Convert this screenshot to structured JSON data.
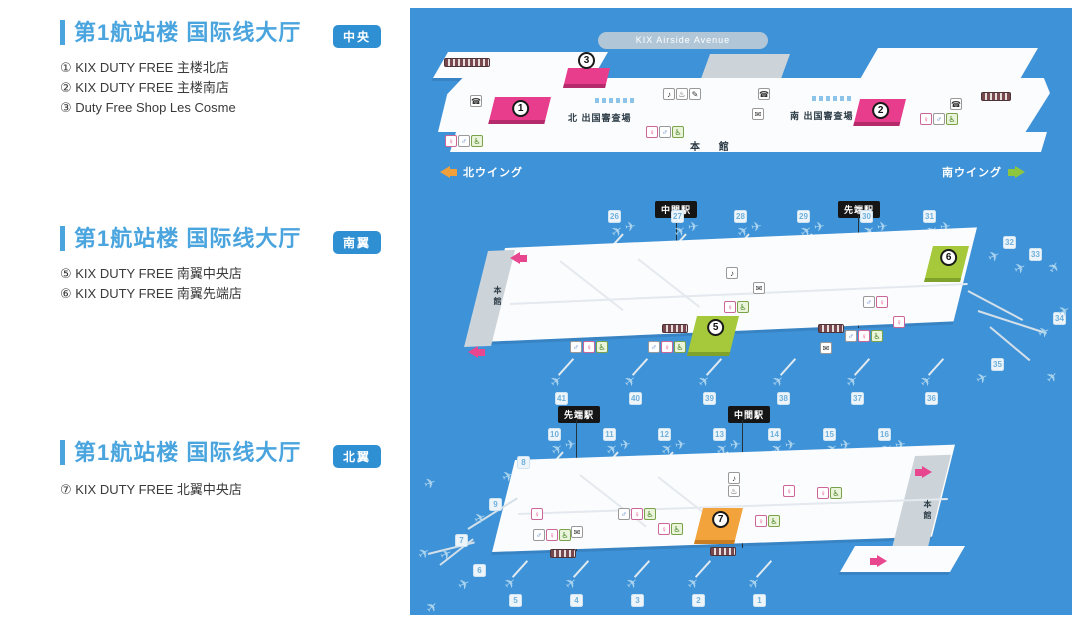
{
  "sections": [
    {
      "title": "第1航站楼 国际线大厅",
      "badge": "中央",
      "items": [
        "① KIX DUTY FREE 主楼北店",
        "② KIX DUTY FREE 主楼南店",
        "③ Duty Free Shop Les Cosme"
      ]
    },
    {
      "title": "第1航站楼 国际线大厅",
      "badge": "南翼",
      "items": [
        "⑤ KIX DUTY FREE 南翼中央店",
        "⑥ KIX DUTY FREE 南翼先端店"
      ]
    },
    {
      "title": "第1航站楼 国际线大厅",
      "badge": "北翼",
      "items": [
        "⑦ KIX DUTY FREE 北翼中央店"
      ]
    }
  ],
  "map": {
    "banner": "KIX Airside Avenue",
    "central": {
      "shops": [
        {
          "num": "1"
        },
        {
          "num": "2"
        },
        {
          "num": "3"
        }
      ],
      "north_inspection": "北 出国審査場",
      "south_inspection": "南 出国審査場",
      "honkan": "本 館",
      "north_wing": "北ウイング",
      "south_wing": "南ウイング"
    },
    "south": {
      "stations": [
        "中間駅",
        "先端駅"
      ],
      "honkan": "本館",
      "gates_top": [
        "26",
        "27",
        "28",
        "29",
        "30",
        "31"
      ],
      "gates_tip": [
        "32",
        "33",
        "34",
        "35"
      ],
      "gates_bottom": [
        "41",
        "40",
        "39",
        "38",
        "37",
        "36"
      ],
      "shops": [
        {
          "num": "5"
        },
        {
          "num": "6"
        }
      ]
    },
    "north": {
      "stations": [
        "先端駅",
        "中間駅"
      ],
      "honkan": "本館",
      "gates_top": [
        "10",
        "11",
        "12",
        "13",
        "14",
        "15",
        "16"
      ],
      "gates_branch": [
        "8",
        "9",
        "7",
        "6"
      ],
      "gates_bottom": [
        "5",
        "4",
        "3",
        "2",
        "1"
      ],
      "shops": [
        {
          "num": "7"
        }
      ]
    }
  },
  "colors": {
    "accent_blue": "#4aa4de",
    "badge_blue": "#2e8fd3",
    "map_bg": "#3e92d7",
    "shop_pink": "#e83c8c",
    "shop_green": "#a5c93a",
    "shop_orange": "#f2a33c",
    "wing_orange": "#f0a03a",
    "wing_green": "#8ec63f",
    "arrow_pink": "#e8468f"
  }
}
